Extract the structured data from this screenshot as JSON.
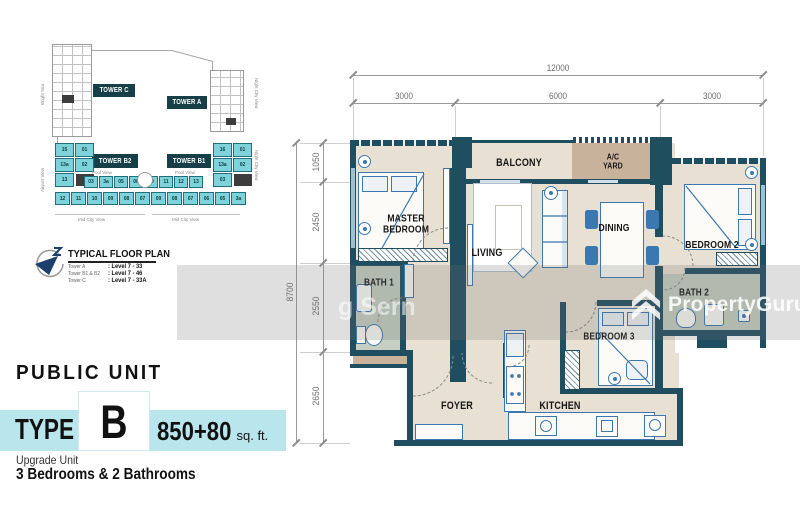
{
  "site_plan": {
    "tower_c": "TOWER C",
    "tower_a": "TOWER A",
    "tower_b2": "TOWER B2",
    "tower_b1": "TOWER B1",
    "b2_units": [
      "15",
      "01",
      "13a",
      "02",
      "13"
    ],
    "b1_units": [
      "16",
      "01",
      "13a",
      "02",
      "03"
    ],
    "mid_row_units": [
      "03",
      "3a",
      "05",
      "06",
      "10",
      "11",
      "12",
      "13"
    ],
    "bottom_row_units": [
      "12",
      "11",
      "10",
      "09",
      "08",
      "07",
      "09",
      "08",
      "07",
      "06",
      "05",
      "3a"
    ],
    "views": {
      "pool_left": "Pool View",
      "pool_right": "Pool View",
      "bottom_left": "Mid City View",
      "bottom_right": "Mid City View",
      "left_top": "Bright Sea",
      "left_bottom": "Airport View",
      "right_top": "Night City View",
      "right_bottom": "Night City View"
    }
  },
  "legend": {
    "title": "TYPICAL FLOOR PLAN",
    "rows": [
      {
        "tower": "Tower A",
        "levels": ": Level 7 - 33"
      },
      {
        "tower": "Tower B1 & B2",
        "levels": ": Level 7 - 46"
      },
      {
        "tower": "Tower C",
        "levels": ": Level 7 - 33A"
      }
    ]
  },
  "unit_info": {
    "category": "PUBLIC UNIT",
    "type_label": "TYPE",
    "type_letter": "B",
    "area_value": "850+80",
    "area_unit": "sq. ft.",
    "subtitle": "Upgrade Unit",
    "description": "3 Bedrooms & 2 Bathrooms"
  },
  "floor_plan": {
    "dimensions": {
      "width_total": "12000",
      "width_segments": [
        "3000",
        "6000",
        "3000"
      ],
      "height_total": "8700",
      "height_segments": [
        "1050",
        "2450",
        "2550",
        "2650"
      ]
    },
    "rooms": {
      "master_bedroom": "MASTER BEDROOM",
      "balcony": "BALCONY",
      "ac_yard": "A/C YARD",
      "bedroom2": "BEDROOM 2",
      "living": "LIVING",
      "dining": "DINING",
      "bath1": "BATH 1",
      "bath2": "BATH 2",
      "bedroom3": "BEDROOM 3",
      "foyer": "FOYER",
      "kitchen": "KITCHEN"
    }
  },
  "watermark": {
    "partial_text": "g Sern",
    "brand": "PropertyGuru"
  },
  "colors": {
    "wall": "#1f4e61",
    "floor": "#e8e1d3",
    "yard": "#c8b29c",
    "bath_floor": "#c6cfc2",
    "accent_teal": "#b9e6ec",
    "site_unit_teal": "#7ed3da",
    "furniture_blue": "#3b77b0",
    "tower_box": "#173f48",
    "compass_navy": "#1d3f6e"
  }
}
